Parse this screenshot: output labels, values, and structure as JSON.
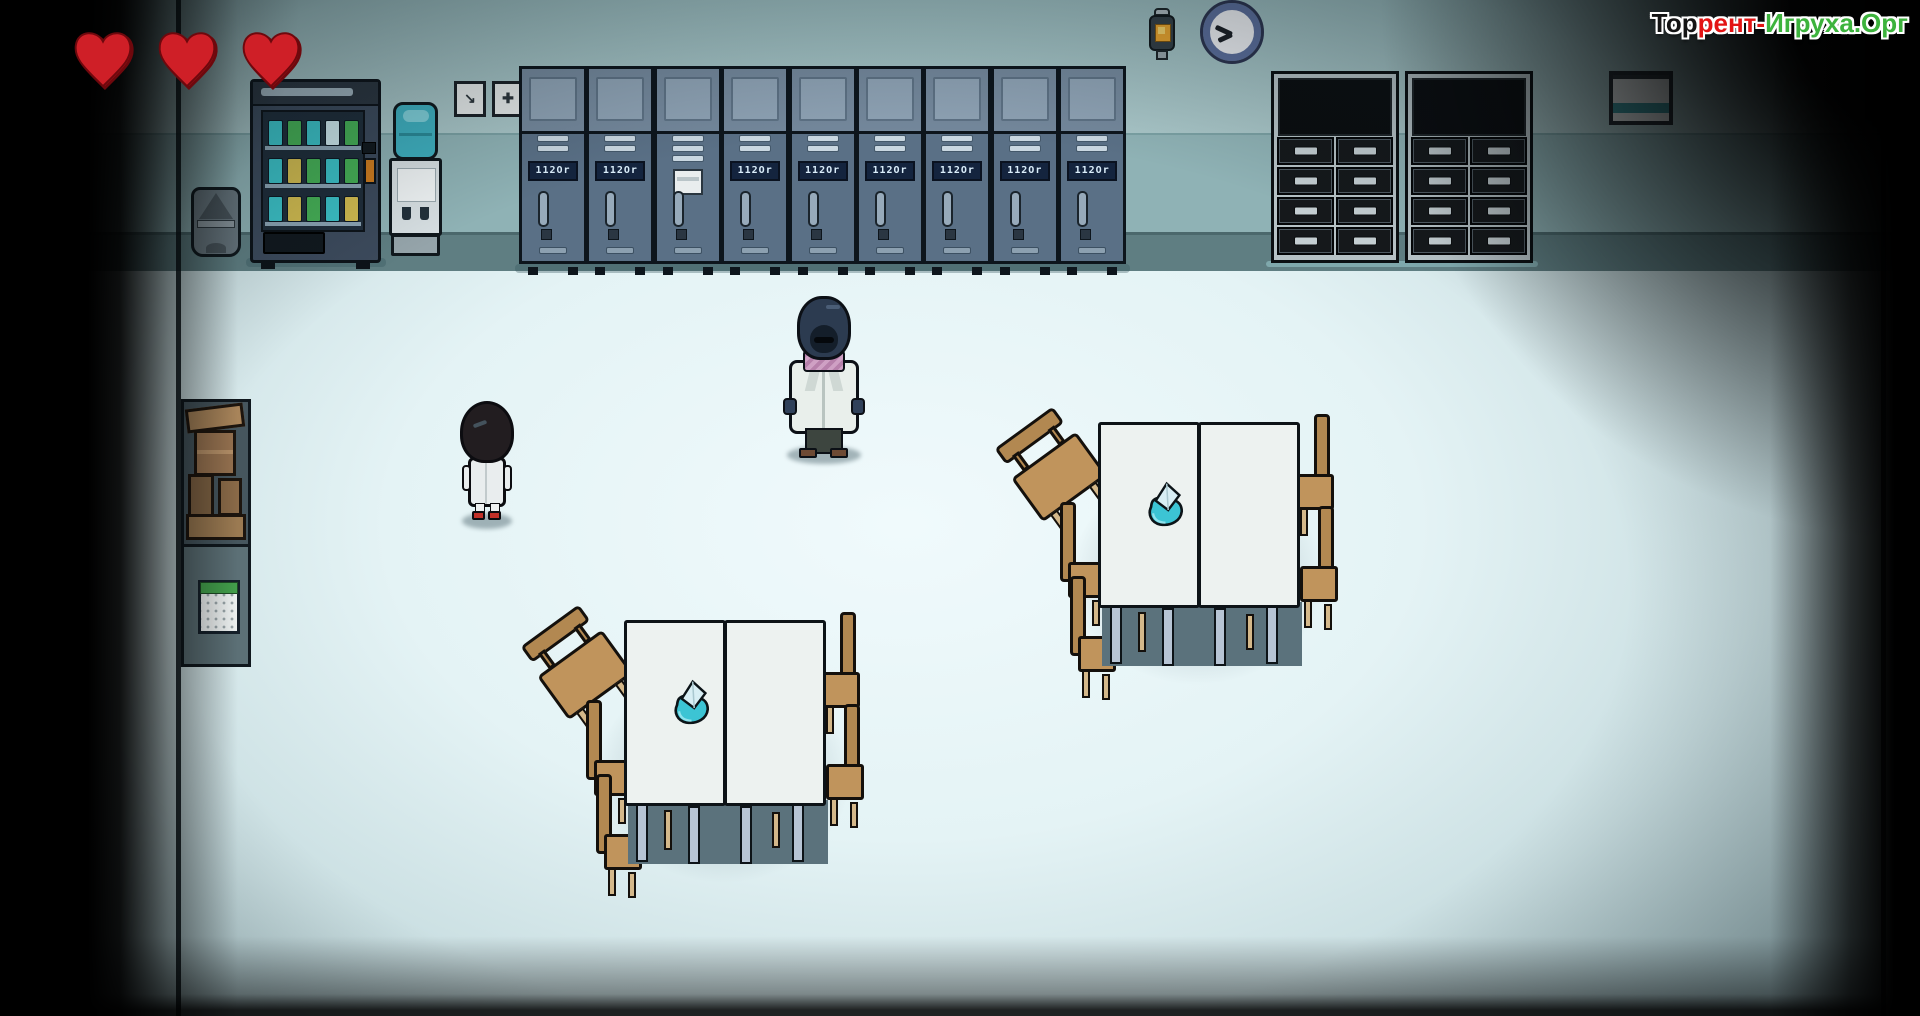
{
  "watermark": {
    "segments": [
      {
        "text": "Тор",
        "color": "#141414"
      },
      {
        "text": "рент-",
        "color": "#e31414"
      },
      {
        "text": "Игруха.Орг",
        "color": "#3db33d"
      }
    ]
  },
  "hud": {
    "hearts": 3,
    "heart_fill": "#cf1f27",
    "heart_shade": "#9d1016",
    "heart_outline": "#6e080d"
  },
  "room": {
    "wall_upper": "#a9c6c8",
    "wall_lower": "#8fb2b5",
    "baseboard": "#5f7e82",
    "floor_center": "#f0fafc",
    "floor_edge": "#a9c4c8"
  },
  "lockers": {
    "count": 9,
    "plate_text": "112Or",
    "paper_locker_index": 2,
    "body_color": "#5a7086",
    "plate_bg": "#14243e",
    "plate_text_color": "#dbeefb"
  },
  "vending": {
    "shelves": [
      [
        "#3cc2c8",
        "#46b056",
        "#3cc2c8",
        "#cfe9ee",
        "#46b056"
      ],
      [
        "#3cc2c8",
        "#d2bc50",
        "#46b056",
        "#3cc2c8",
        "#46b056"
      ],
      [
        "#3cc2c8",
        "#d2bc50",
        "#46b056",
        "#3cc2c8",
        "#d2bc50"
      ]
    ],
    "coin_slot_color": "#cd7b1e"
  },
  "cabinets": {
    "count": 2,
    "drawer_rows": 4,
    "drawer_cols": 2,
    "positions_x": [
      1271,
      1405
    ]
  },
  "wall_signs": [
    {
      "icon": "arrow-down-right-icon",
      "glyph": "↘"
    },
    {
      "icon": "cross-icon",
      "glyph": "✚"
    }
  ],
  "clock": {
    "ring_color": "#5c6f9d",
    "face_color": "#eef0f4"
  },
  "lamp": {
    "glow_color": "#e9a42e"
  },
  "whiteboard": {
    "stripe_color": "#3f9aa2"
  },
  "calendar": {
    "header_color": "#43a04c"
  },
  "characters": {
    "doctor": {
      "coat": "#e9efeb",
      "head": "#2c3b50",
      "scarf": "#cfa0c4",
      "pants": "#3d453f",
      "shoes": "#6e4a34"
    },
    "child": {
      "hair": "#221d20",
      "gown": "#e9edee",
      "shoes": "#c23028"
    }
  },
  "tables": {
    "groups": [
      {
        "x": 1014,
        "y": 406
      },
      {
        "x": 540,
        "y": 604
      }
    ],
    "cap_color": "#3cc4d4",
    "cap_flap": "#d8eef4",
    "top_color": "#edf2f0",
    "chair_wood": "#b28851"
  }
}
